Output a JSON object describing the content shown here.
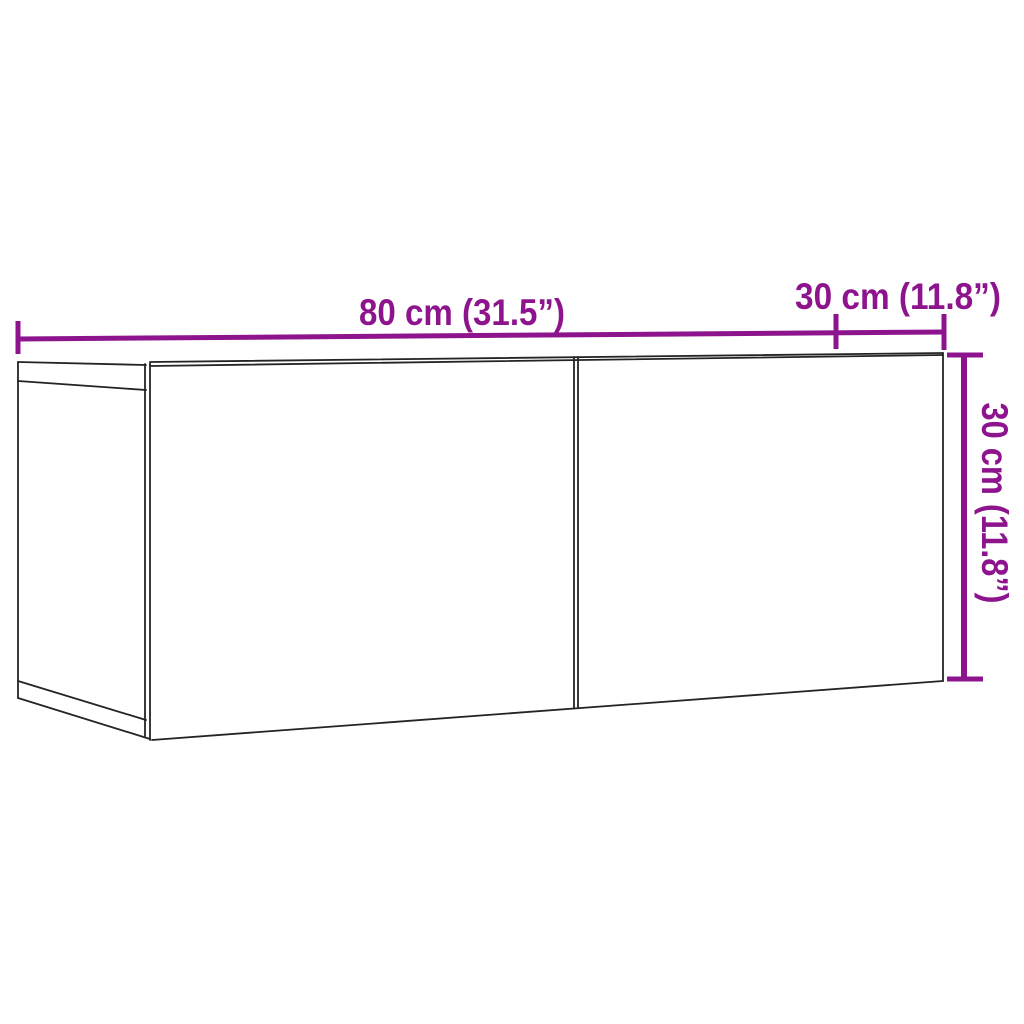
{
  "page": {
    "width": 1024,
    "height": 1024,
    "background": "#ffffff"
  },
  "colors": {
    "dimension_accent": "#8D148D",
    "drawing_outline": "#242424"
  },
  "diagram": {
    "subject": "wall-mounted-tv-cabinet-two-doors-3d-outline-drawing",
    "labels": {
      "width_top": "80 cm (31.5”)",
      "depth_top_right": "30 cm (11.8”)",
      "height_right": "30 cm (11.8”)"
    },
    "dimensions": {
      "width_cm": 80,
      "width_inch": 31.5,
      "depth_cm": 30,
      "depth_inch": 11.8,
      "height_cm": 30,
      "height_inch": 11.8
    }
  }
}
